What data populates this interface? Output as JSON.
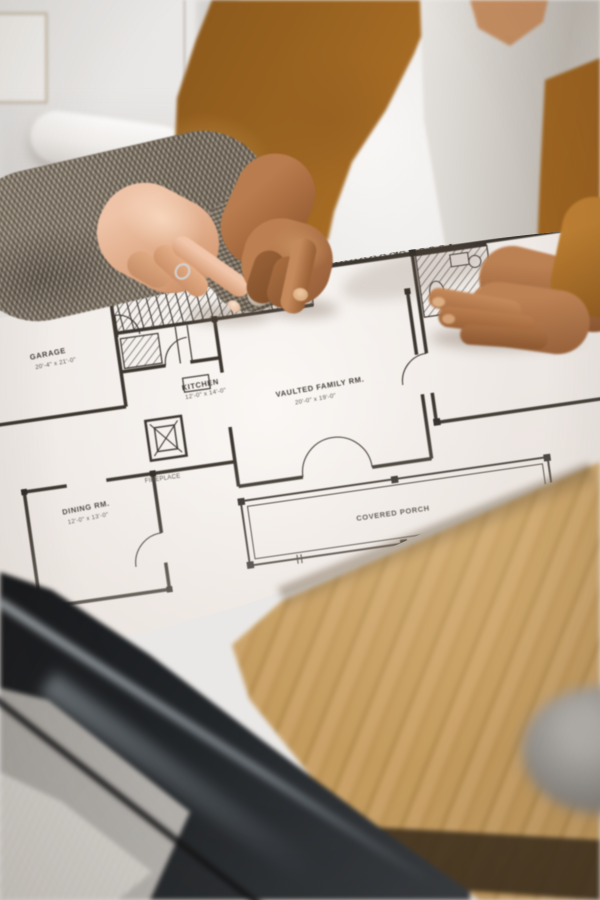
{
  "scene": {
    "type": "photograph",
    "subject": "Two people pointing at an architectural floor-plan blueprint on a desk"
  },
  "floor_plan": {
    "labels": {
      "garage": {
        "name": "GARAGE",
        "dims": "20'-4\" x 21'-0\""
      },
      "kitchen": {
        "name": "KITCHEN",
        "dims": "12'-0\" x 14'-0\""
      },
      "family": {
        "name": "VAULTED FAMILY RM.",
        "dims": "20'-0\" x 19'-0\""
      },
      "mstr": {
        "name": "MSTR SUITE",
        "dims": "13'-0\" x 17'-4\""
      },
      "dining": {
        "name": "DINING RM.",
        "dims": "12'-0\" x 13'-0\""
      },
      "fireplace": {
        "name": "FIREPLACE"
      },
      "porch": {
        "name": "COVERED PORCH"
      }
    }
  },
  "palette": {
    "wall": "#eae8e6",
    "blazer": "#b5762a",
    "shirt": "#f2f0ed",
    "tweed_sleeve": "#8d8173",
    "paper": "#f0ebe7",
    "plan_ink": "#3c362f",
    "wood_table": "#c29a62",
    "dark_object": "#1a1b1d",
    "carpet": "#ccc8c2"
  }
}
